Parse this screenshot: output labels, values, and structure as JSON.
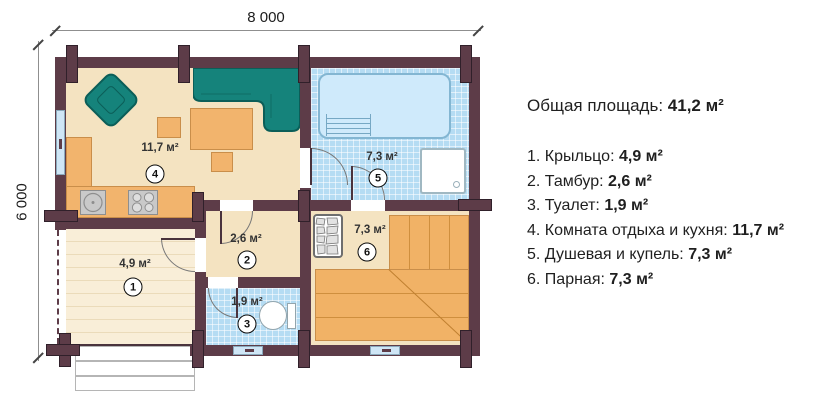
{
  "dimensions": {
    "width": "8 000",
    "height": "6 000"
  },
  "rooms": [
    {
      "number": "1",
      "name": "Крыльцо",
      "area": "4,9 м²"
    },
    {
      "number": "2",
      "name": "Тамбур",
      "area": "2,6 м²"
    },
    {
      "number": "3",
      "name": "Туалет",
      "area": "1,9 м²"
    },
    {
      "number": "4",
      "name": "Комната отдыха и кухня",
      "area": "11,7 м²"
    },
    {
      "number": "5",
      "name": "Душевая и купель",
      "area": "7,3 м²"
    },
    {
      "number": "6",
      "name": "Парная",
      "area": "7,3 м²"
    }
  ],
  "legend": {
    "total_label": "Общая площадь:",
    "total_value": "41,2 м²",
    "items": [
      {
        "label": "1. Крыльцо:",
        "value": "4,9 м²"
      },
      {
        "label": "2. Тамбур:",
        "value": "2,6 м²"
      },
      {
        "label": "3. Туалет:",
        "value": "1,9 м²"
      },
      {
        "label": "4. Комната отдыха и кухня:",
        "value": "11,7 м²"
      },
      {
        "label": "5. Душевая и купель:",
        "value": "7,3 м²"
      },
      {
        "label": "6. Парная:",
        "value": "7,3 м²"
      }
    ]
  },
  "colors": {
    "wall": "#5d3c48",
    "floor_beige": "#f4e3c1",
    "tile_blue": "#b5dcf3",
    "pool_blue": "#cfeafb",
    "furniture_orange": "#f2b46d",
    "sofa_teal": "#15837b",
    "bench_wood": "#f1b266"
  }
}
